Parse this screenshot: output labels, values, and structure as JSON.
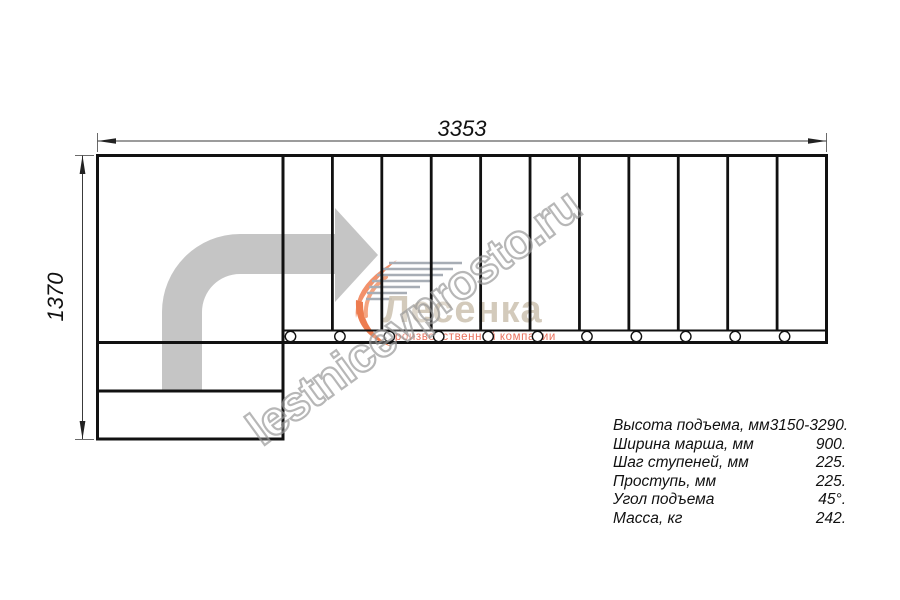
{
  "dimensions": {
    "width_mm": "3353",
    "height_mm": "1370"
  },
  "spec_table": {
    "rows": [
      {
        "label": "Высота подъема, мм",
        "value": "3150-3290."
      },
      {
        "label": "Ширина марша, мм",
        "value": "900."
      },
      {
        "label": "Шаг ступеней, мм",
        "value": "225."
      },
      {
        "label": "Проступь, мм",
        "value": "225."
      },
      {
        "label": "Угол подъема",
        "value": "45°."
      },
      {
        "label": "Масса, кг",
        "value": "242."
      }
    ]
  },
  "watermark": {
    "text": "lestnicevprosto.ru"
  },
  "logo": {
    "brand": "Лесенка",
    "tagline": "производственной компании"
  },
  "diagram": {
    "type": "staircase-plan-view",
    "tread_count": 11,
    "bolt_count": 11,
    "landing_steps": 2,
    "direction_arrow": "up-then-right"
  },
  "colors": {
    "outline": "#111111",
    "dimension": "#3a3a3a",
    "arrow_fill": "#c5c5c5",
    "watermark_stroke": "#9c9c9c",
    "logo_orange": "#f2916b",
    "logo_text": "#cec4b4",
    "logo_tagline": "#e23c1e"
  }
}
